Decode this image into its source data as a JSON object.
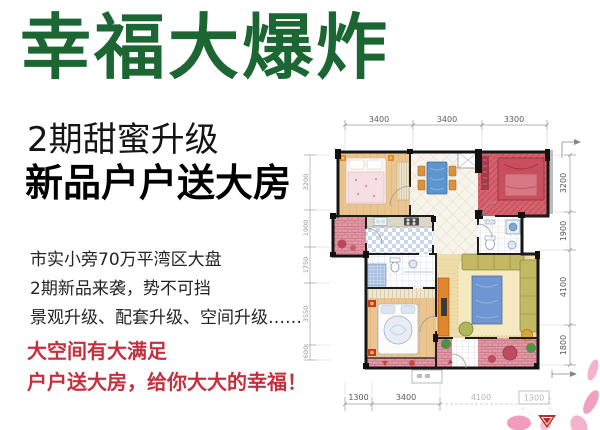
{
  "poster": {
    "title": "幸福大爆炸",
    "subtitle_light": "2期甜蜜升级",
    "subtitle_bold": "新品户户送大房",
    "body_lines": [
      "市实小旁70万平湾区大盘",
      "2期新品来袭，势不可挡",
      "景观升级、配套升级、空间升级……"
    ],
    "highlight_lines": [
      "大空间有大满足",
      "户户送大房，给你大大的幸福！"
    ],
    "colors": {
      "title_green": "#1b6633",
      "highlight_red": "#c5303f",
      "gift_room_red": "#d5626d",
      "balcony_pink": "#e29aa6"
    }
  },
  "floorplan": {
    "dim_top": [
      "3400",
      "3400",
      "3300"
    ],
    "dim_right": [
      "3200",
      "1900",
      "4100",
      "1800"
    ],
    "dim_left": [
      "3200",
      "1900",
      "1750",
      "3550",
      "600"
    ],
    "dim_bottom": [
      "1300",
      "3400",
      "4100",
      "1300"
    ]
  }
}
